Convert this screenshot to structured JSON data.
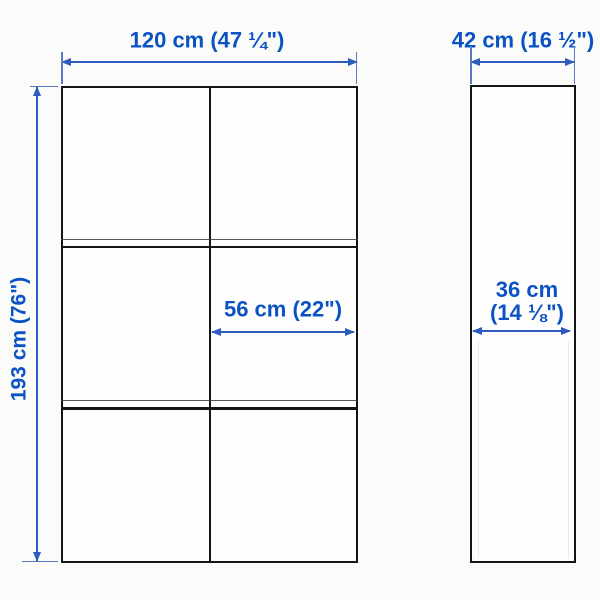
{
  "diagram": {
    "type": "product-dimension-diagram",
    "views": {
      "front_view": {
        "name": "front-view",
        "grid": {
          "columns": 2,
          "rows": 3
        },
        "width_label": "120 cm (47 ¼\")",
        "height_label": "193 cm (76\")",
        "inner_width_label": "56 cm (22\")"
      },
      "side_view": {
        "name": "side-view",
        "width_label": "42 cm (16 ½\")",
        "depth_label_line1": "36 cm",
        "depth_label_line2": "(14 ⅛\")"
      }
    },
    "colors": {
      "dimension_text_blue": "#0b52c4",
      "dimension_line_blue": "#2e5cbc",
      "outline_black": "#151515",
      "background": "#fbfbfa"
    }
  }
}
